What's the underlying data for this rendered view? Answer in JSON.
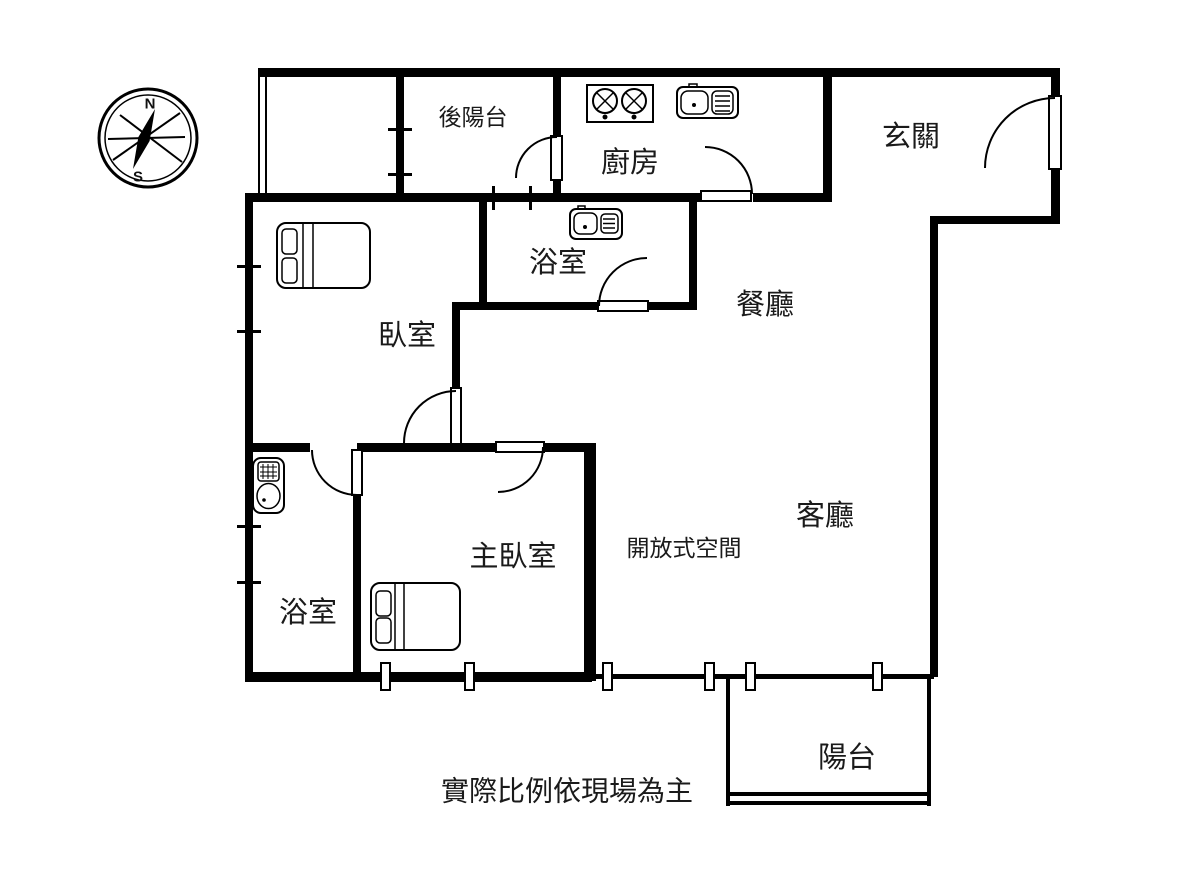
{
  "compass": {
    "north": "N",
    "south": "S"
  },
  "rooms": {
    "back_balcony": {
      "label": "後陽台"
    },
    "kitchen": {
      "label": "廚房"
    },
    "entrance": {
      "label": "玄關"
    },
    "bathroom_upper": {
      "label": "浴室"
    },
    "dining_room": {
      "label": "餐廳"
    },
    "bedroom": {
      "label": "臥室"
    },
    "master_bedroom": {
      "label": "主臥室"
    },
    "open_space": {
      "label": "開放式空間"
    },
    "living_room": {
      "label": "客廳"
    },
    "bathroom_lower": {
      "label": "浴室"
    },
    "balcony": {
      "label": "陽台"
    }
  },
  "footer": {
    "disclaimer": "實際比例依現場為主"
  },
  "fixtures": {
    "bedroom_bed": "double-bed",
    "master_bedroom_bed": "double-bed",
    "kitchen_stove": "two-burner-stove",
    "kitchen_sink": "sink-with-drainboard",
    "bathroom_upper_sink": "sink-with-drainboard",
    "bathroom_lower_toilet": "toilet"
  },
  "colors": {
    "wall": "#000000",
    "background": "#ffffff",
    "text": "#1a1a1a"
  }
}
